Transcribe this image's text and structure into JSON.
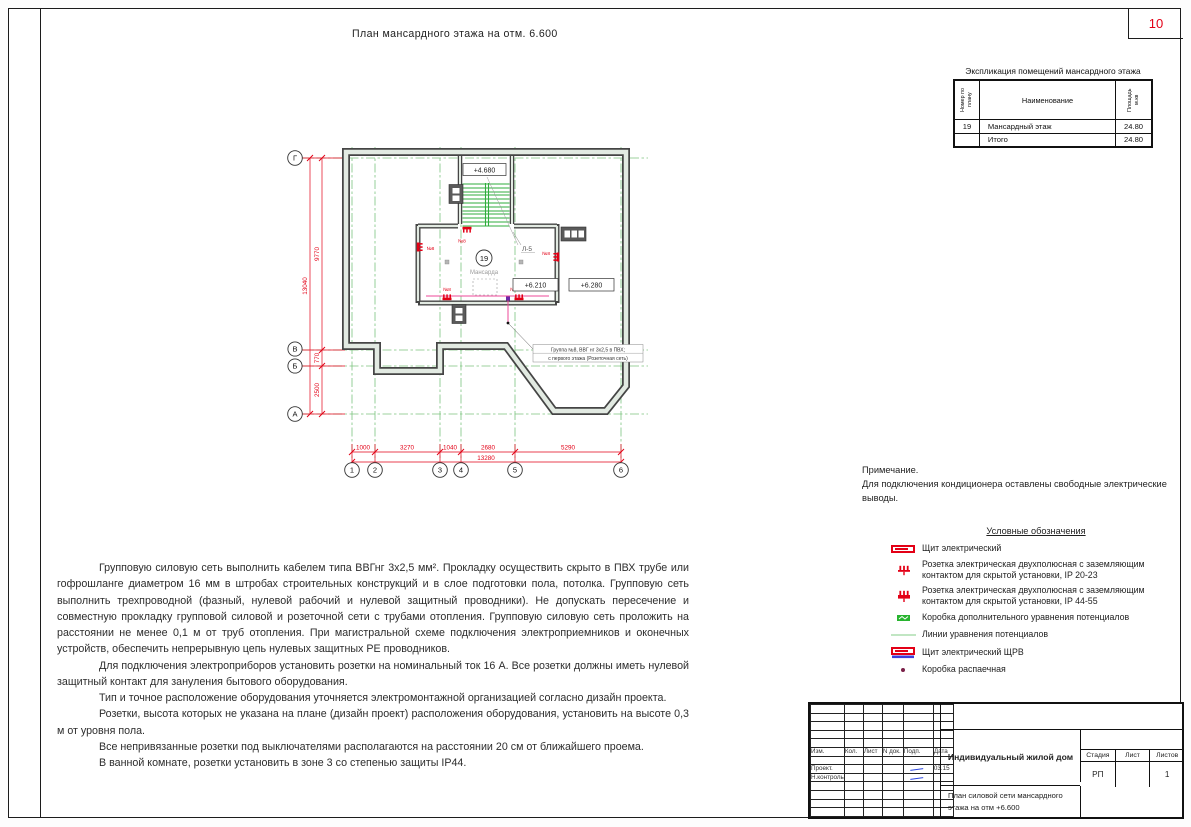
{
  "page": {
    "number": "10"
  },
  "drawing_title": "План мансардного этажа на отм. 6.600",
  "explication": {
    "title": "Экспликация помещений мансардного этажа",
    "col_number": "Номер по плану",
    "col_name": "Наименование",
    "col_area": "Площадь м.кв",
    "rows": [
      {
        "num": "19",
        "name": "Мансардный этаж",
        "area": "24.80"
      },
      {
        "num": "",
        "name": "Итого",
        "area": "24.80"
      }
    ]
  },
  "plan": {
    "room_number": "19",
    "room_name": "Мансарда",
    "stair_label": "Л-5",
    "elevations": {
      "stair": "+4.680",
      "room": "+6.210",
      "outside": "+6.280"
    },
    "outlet_label": "№8",
    "callout_line1": "Группа №8, ВВГ нг 3х2,5 в ПВХ;",
    "callout_line2": "с первого этажа (Розеточная сеть)",
    "grid_cols": [
      "1",
      "2",
      "3",
      "4",
      "5",
      "6"
    ],
    "grid_rows": [
      "Г",
      "В",
      "Б",
      "А"
    ],
    "dims_bottom": [
      "1000",
      "3270",
      "1040",
      "2680",
      "5290"
    ],
    "dim_bottom_total": "13280",
    "dims_left": [
      "9770",
      "770",
      "2500"
    ],
    "dim_left_total": "13040"
  },
  "notes": {
    "paragraphs": [
      "Групповую силовую сеть выполнить кабелем типа ВВГнг 3х2,5 мм². Прокладку осуществить скрыто в ПВХ трубе или гофрошланге диаметром 16 мм в штробах строительных конструкций и в слое подготовки пола, потолка. Групповую сеть выполнить трехпроводной (фазный, нулевой рабочий и нулевой защитный проводники). Не допускать пересечение и совместную прокладку групповой силовой и розеточной сети с трубами отопления. Групповую силовую сеть проложить на расстоянии не менее 0,1 м от труб отопления. При магистральной схеме подключения электроприемников и оконечных устройств, обеспечить непрерывную цепь нулевых защитных PE проводников.",
      "Для подключения электроприборов установить розетки на номинальный ток 16 А. Все розетки должны иметь нулевой защитный контакт для зануления бытового оборудования.",
      "Тип и точное расположение оборудования уточняется электромонтажной организацией согласно дизайн проекта.",
      "Розетки, высота которых не указана на плане (дизайн проект) расположения оборудования, установить на высоте 0,3 м от уровня пола.",
      "Все непривязанные розетки под выключателями располагаются на расстоянии 20 см от ближайшего проема.",
      "В  ванной комнате,  розетки установить в зоне 3 со степенью защиты IP44."
    ]
  },
  "remark": {
    "title": "Примечание.",
    "text": "Для подключения кондиционера оставлены свободные электрические выводы."
  },
  "legend": {
    "title": "Условные обозначения",
    "items": [
      {
        "icon": "electrical-panel-icon",
        "label": "Щит электрический"
      },
      {
        "icon": "socket-open-icon",
        "label": "Розетка электрическая двухполюсная с заземляющим контактом для скрытой установки, IP 20-23"
      },
      {
        "icon": "socket-filled-icon",
        "label": "Розетка электрическая двухполюсная с заземляющим контактом для скрытой установки, IP 44-55"
      },
      {
        "icon": "potential-box-icon",
        "label": "Коробка дополнительного уравнения потенциалов"
      },
      {
        "icon": "potential-line-icon",
        "label": "Линии уравнения потенциалов"
      },
      {
        "icon": "electrical-panel-shrv-icon",
        "label": "Щит электрический ЩРВ"
      },
      {
        "icon": "junction-box-icon",
        "label": "Коробка распаечная"
      }
    ]
  },
  "titleblock": {
    "cols": [
      "Изм.",
      "Кол.",
      "Лист",
      "N док.",
      "Подп.",
      "Дата"
    ],
    "rows": [
      {
        "label": "Проект.",
        "date": "03.15"
      },
      {
        "label": "Н.контроль",
        "date": ""
      }
    ],
    "project": "Индивидуальный жилой дом",
    "stage_label": "Стадия",
    "sheet_label": "Лист",
    "sheets_label": "Листов",
    "stage": "РП",
    "sheet": "",
    "sheets": "1",
    "subtitle1": "План силовой сети мансардного",
    "subtitle2": "этажа на отм +6.600"
  },
  "colors": {
    "dim_red": "#e30016",
    "grid_green": "#7cc47f",
    "stair_green": "#2fae3d",
    "wire_magenta": "#ec4899",
    "signature_blue": "#2b46e0"
  }
}
